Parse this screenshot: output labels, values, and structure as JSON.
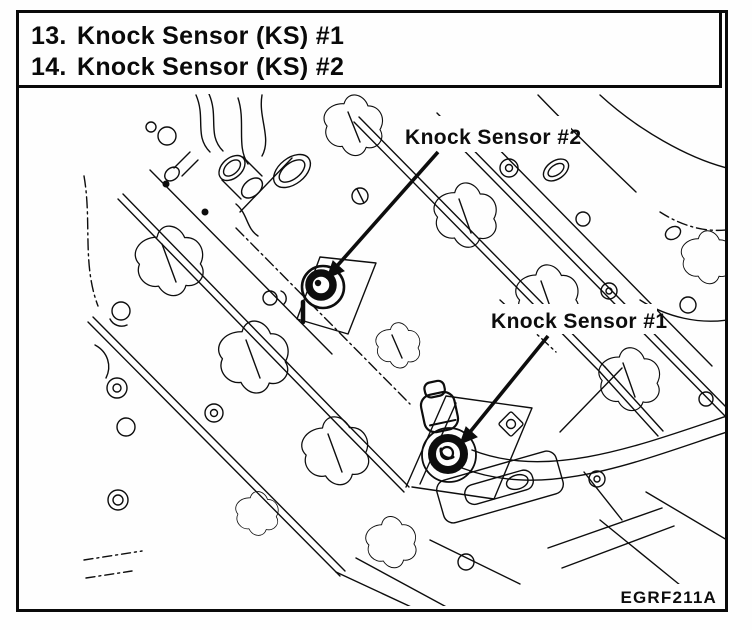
{
  "header": {
    "items": [
      {
        "number": "13.",
        "label": "Knock Sensor (KS) #1"
      },
      {
        "number": "14.",
        "label": "Knock Sensor (KS) #2"
      }
    ]
  },
  "diagram": {
    "labels": {
      "sensor2": "Knock Sensor #2",
      "sensor1": "Knock Sensor #1"
    },
    "figure_code": "EGRF211A",
    "symbols": {
      "sensor1": "knock-sensor-1-marker",
      "sensor2": "knock-sensor-2-marker"
    },
    "ink_color": "#0d0d0d",
    "paper_color": "#fefefe"
  }
}
